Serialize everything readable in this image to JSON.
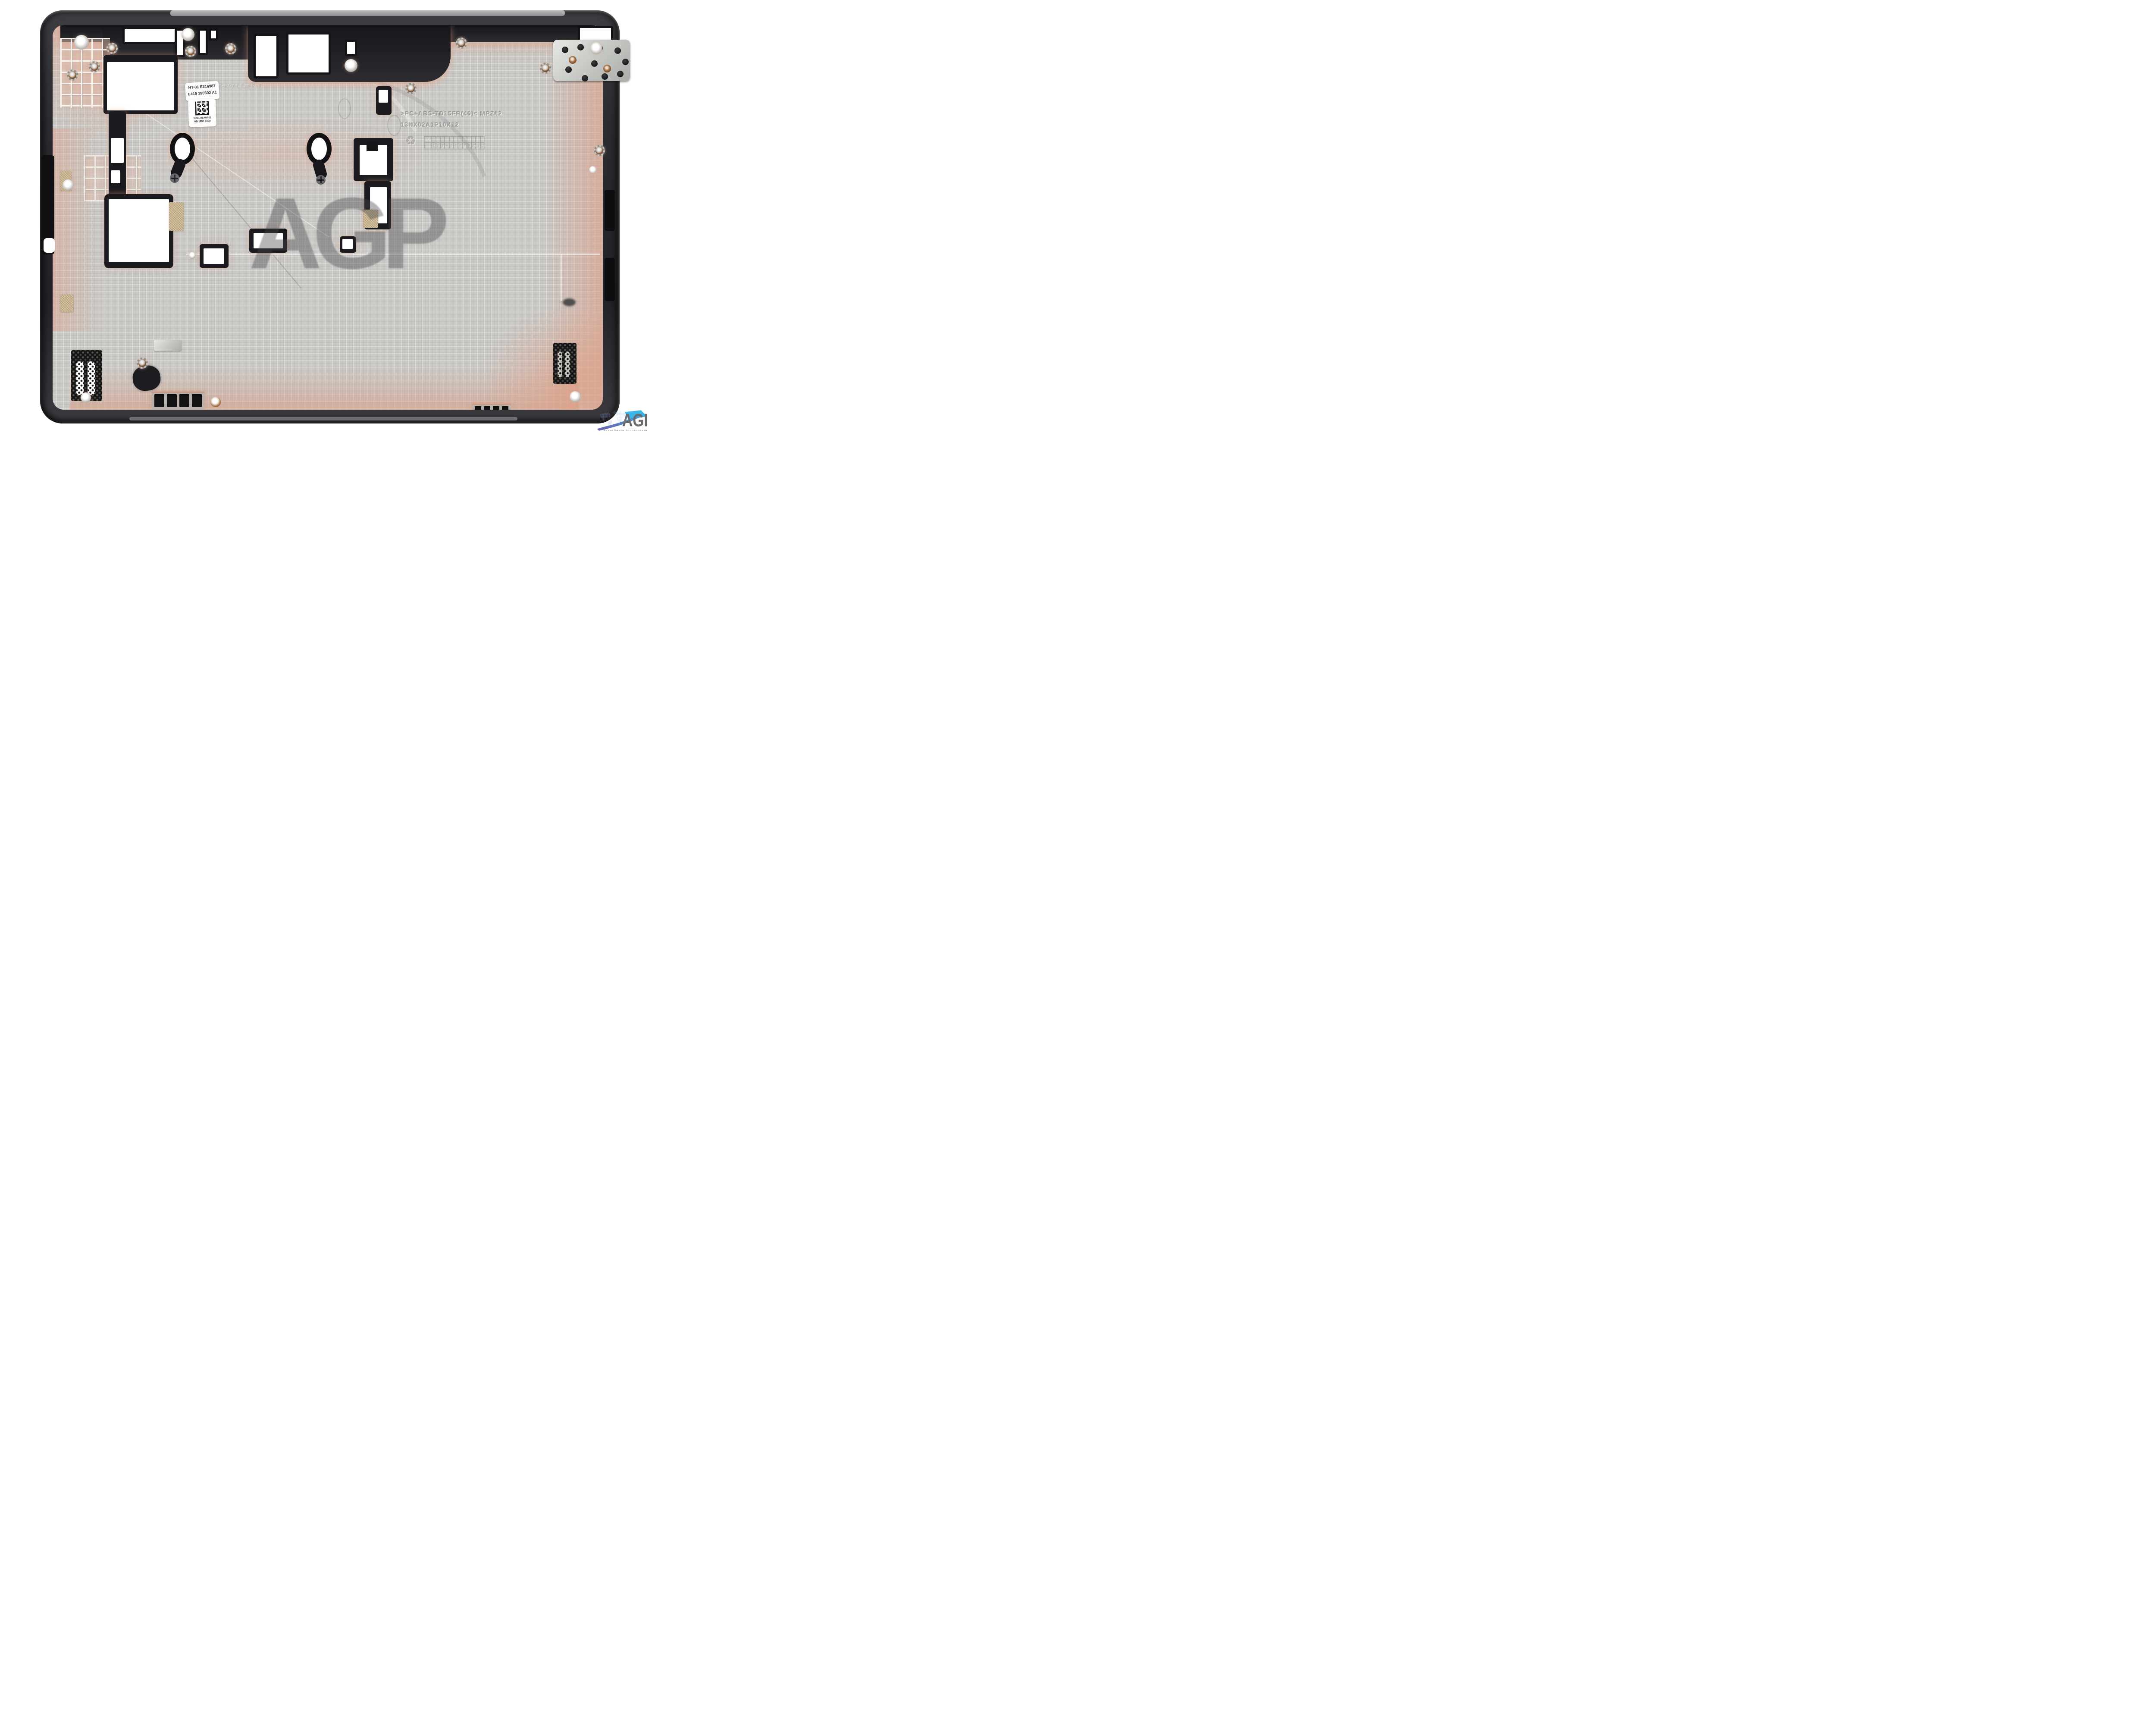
{
  "stickers": {
    "part_label": {
      "line1": "HT-01 E316987",
      "line2": "E419 190502 A1"
    },
    "barcode_label": {
      "line1": "13N1-86A0A01",
      "line2": "0B 1955 3328",
      "barcode_type": "datamatrix"
    }
  },
  "molded_markings": {
    "material_code": ">PC+ABS-TD15FR(40)< MPZ#2",
    "mold_number": "13NX02A1P10X12",
    "faint_code": "C204EE #2-1",
    "recycle_symbol": "♻",
    "rev_table": {
      "header": "REV",
      "cells": [
        "1",
        "2",
        "3",
        "4",
        "5",
        "6",
        "7",
        "8",
        "9",
        "10",
        "11",
        "12"
      ]
    }
  },
  "watermark": {
    "text": "AGP"
  },
  "logo": {
    "monogram": "AGI",
    "tagline": "AssetGenie Incorporated"
  },
  "colors": {
    "background": "#ffffff",
    "case_wall": "#2c2c30",
    "panel_silver": "#c9c8c5",
    "copper_tint": "#dfa388",
    "cutout_black": "#141418",
    "tape_tan": "#c8b188",
    "mesh_black": "#151515",
    "watermark_gray": "rgba(70,70,75,0.40)",
    "logo_letter_gray": "#6b6b6e",
    "logo_cyan": "#39b7e9",
    "logo_purple": "#6a5fa8",
    "logo_map_blue": "#7d9ce0"
  }
}
